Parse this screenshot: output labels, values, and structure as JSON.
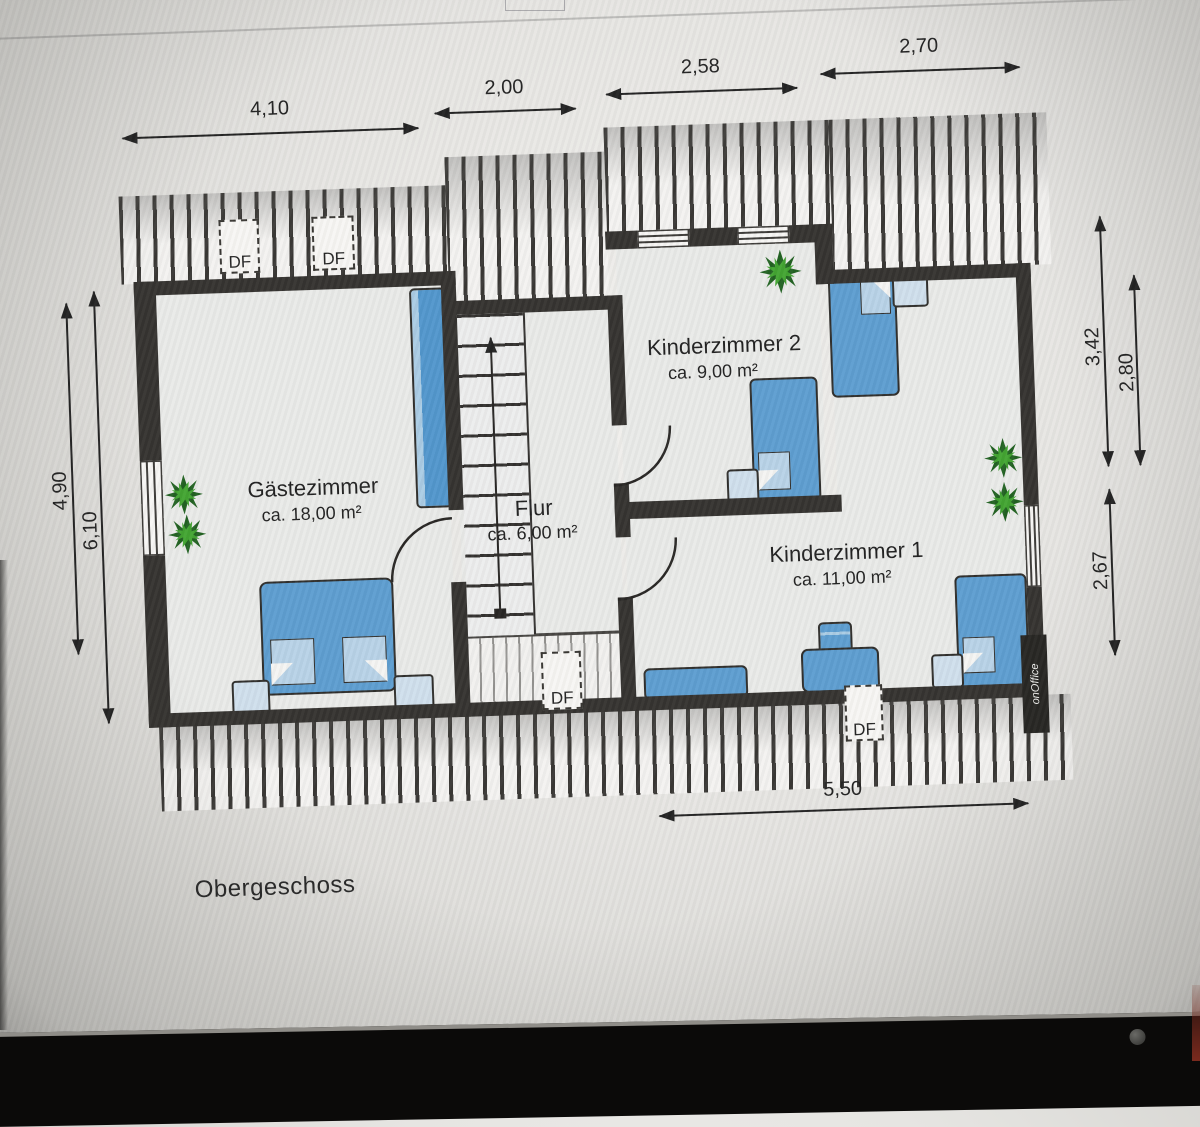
{
  "labels": {
    "floor": "Obergeschoss",
    "roof_window": "DF",
    "watermark": "onOffice"
  },
  "rooms": [
    {
      "name": "Gästezimmer",
      "area": "ca. 18,00 m²"
    },
    {
      "name": "Flur",
      "area": "ca. 6,00 m²"
    },
    {
      "name": "Kinderzimmer 2",
      "area": "ca. 9,00 m²"
    },
    {
      "name": "Kinderzimmer 1",
      "area": "ca. 11,00 m²"
    }
  ],
  "dimensions": {
    "top": [
      "4,10",
      "2,00",
      "2,58",
      "2,70"
    ],
    "left": [
      "4,90",
      "6,10"
    ],
    "right": [
      "3,42",
      "2,80",
      "2,67"
    ],
    "bottom": [
      "5,50"
    ]
  },
  "colors": {
    "wall": "#312f2c",
    "furniture_blue": "#5b9cd0",
    "furniture_light": "#cfdfec",
    "plant_dark": "#1e5f1e",
    "plant_light": "#3fa32e"
  }
}
